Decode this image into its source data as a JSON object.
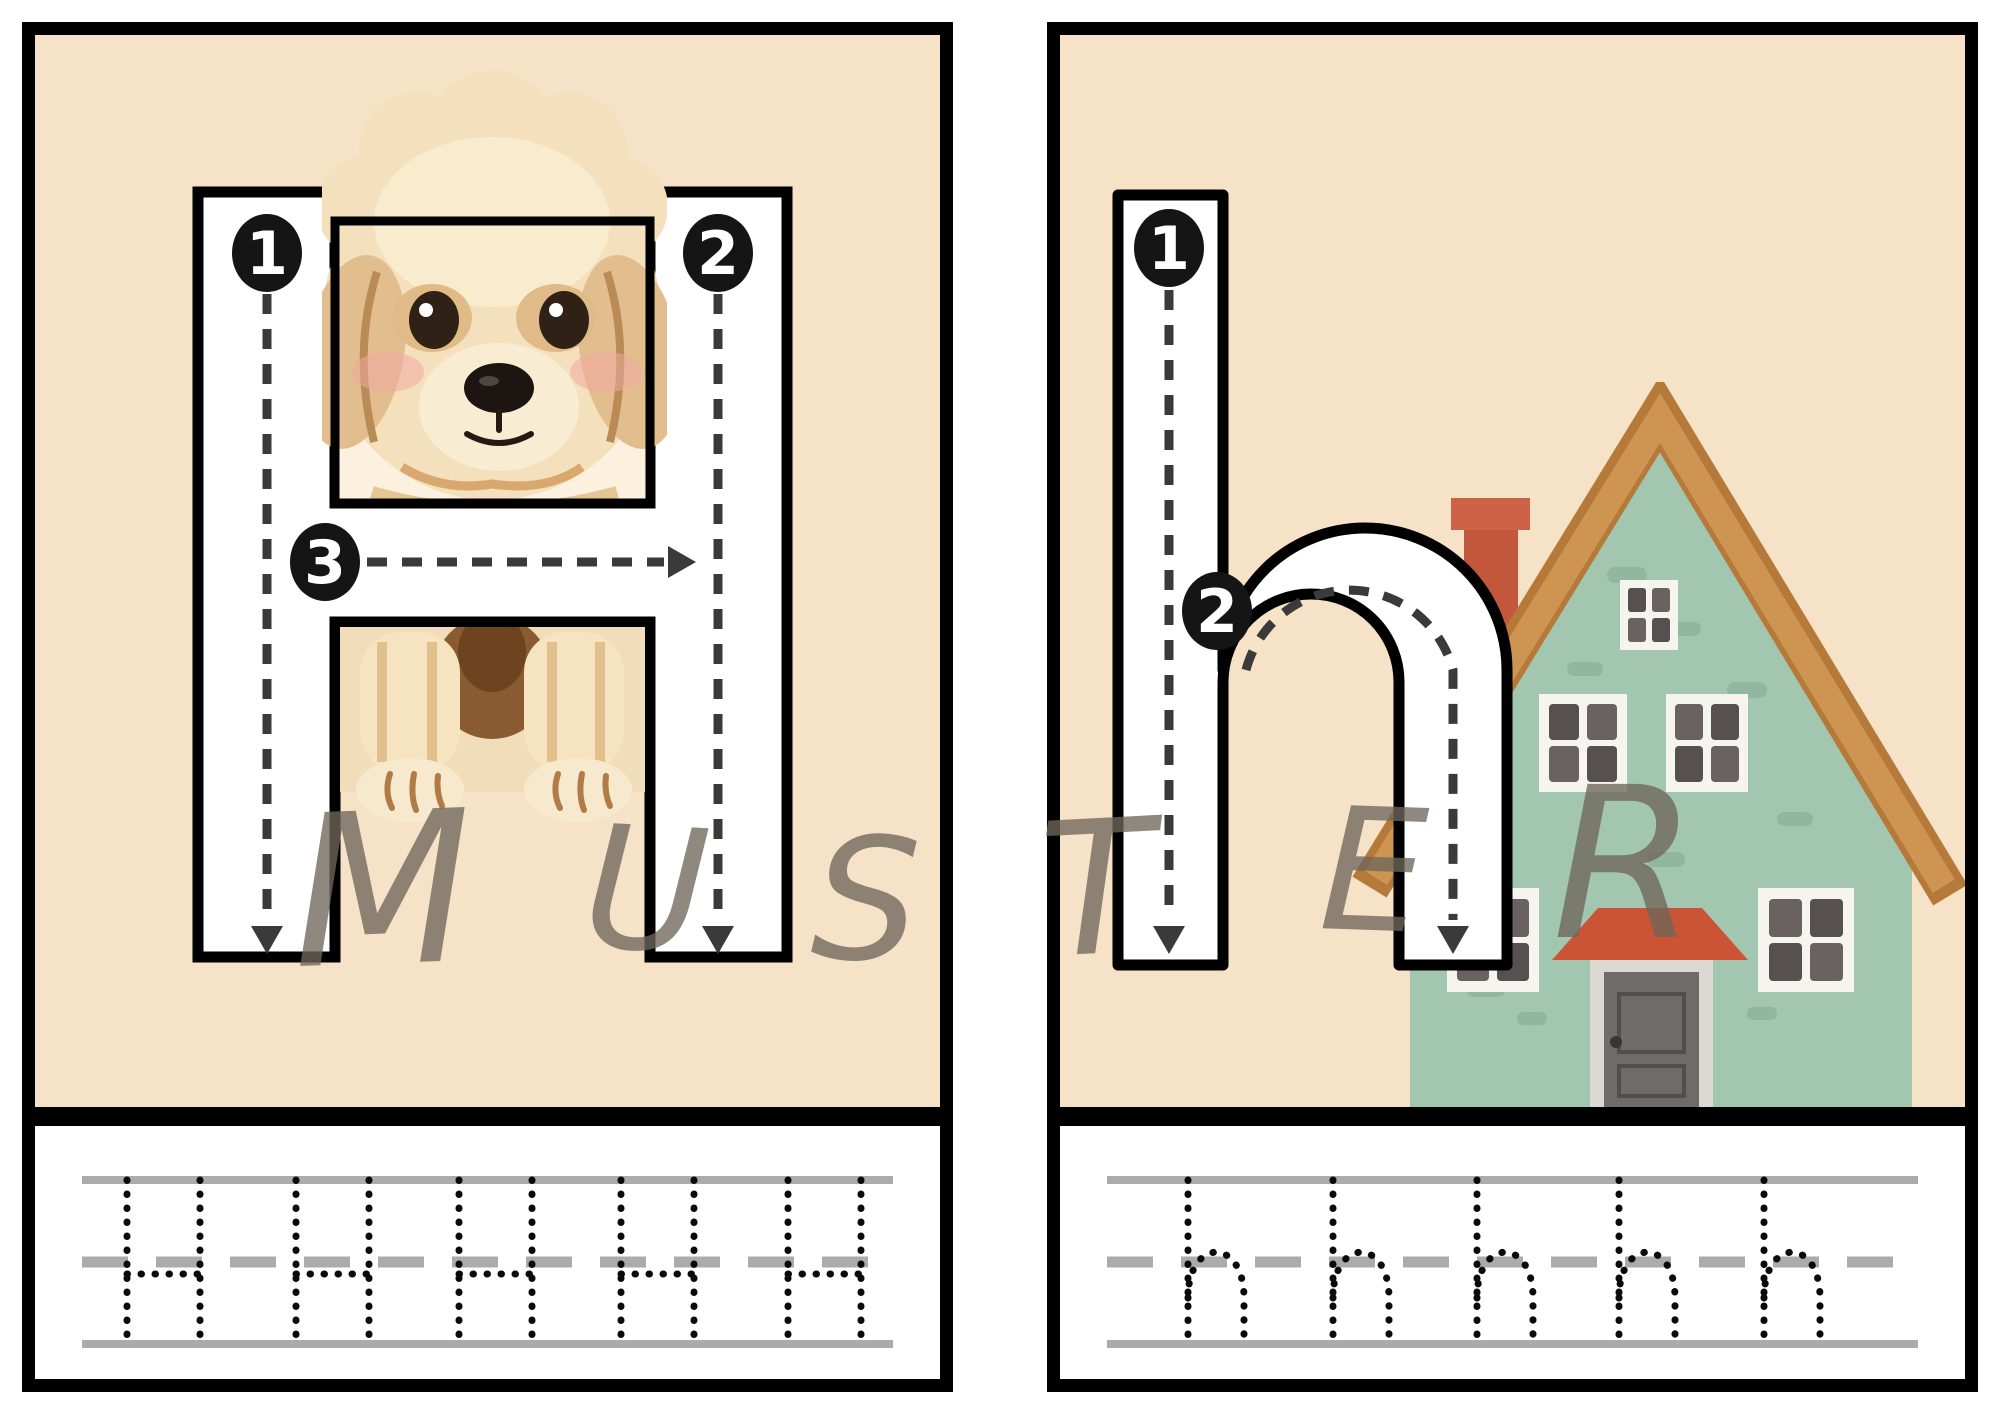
{
  "page": {
    "background": "#ffffff",
    "type": "letter-tracing-worksheet"
  },
  "watermark": {
    "text": "MUSTER",
    "letters": [
      "M",
      "U",
      "S",
      "T",
      "E",
      "R"
    ],
    "color": "#6F675B"
  },
  "cards": [
    {
      "id": "uppercase-H",
      "letter": "H",
      "case": "uppercase",
      "illustration": "puppy",
      "background": "#F6E2C6",
      "stroke_numbers": [
        "1",
        "2",
        "3"
      ],
      "practice": {
        "letter": "H",
        "repetitions": 5
      }
    },
    {
      "id": "lowercase-h",
      "letter": "h",
      "case": "lowercase",
      "illustration": "house",
      "background": "#F6E2C6",
      "stroke_numbers": [
        "1",
        "2"
      ],
      "practice": {
        "letter": "h",
        "repetitions": 5
      }
    }
  ],
  "colors": {
    "card_border": "#000000",
    "card_background": "#F6E2C6",
    "practice_background": "#FFFFFF",
    "guide_line_gray": "#ABABAB",
    "trace_dots": "#0A0A0A",
    "stroke_guide_dash": "#3A3A3A",
    "number_badge": "#151515",
    "number_badge_text": "#FFFFFF",
    "letter_fill": "#FFFFFF",
    "letter_outline": "#000000",
    "house_wall": "#A3C6B1",
    "house_roof": "#C98E4F",
    "house_chimney": "#C2573C",
    "puppy_fur": "#F4E0BC"
  }
}
